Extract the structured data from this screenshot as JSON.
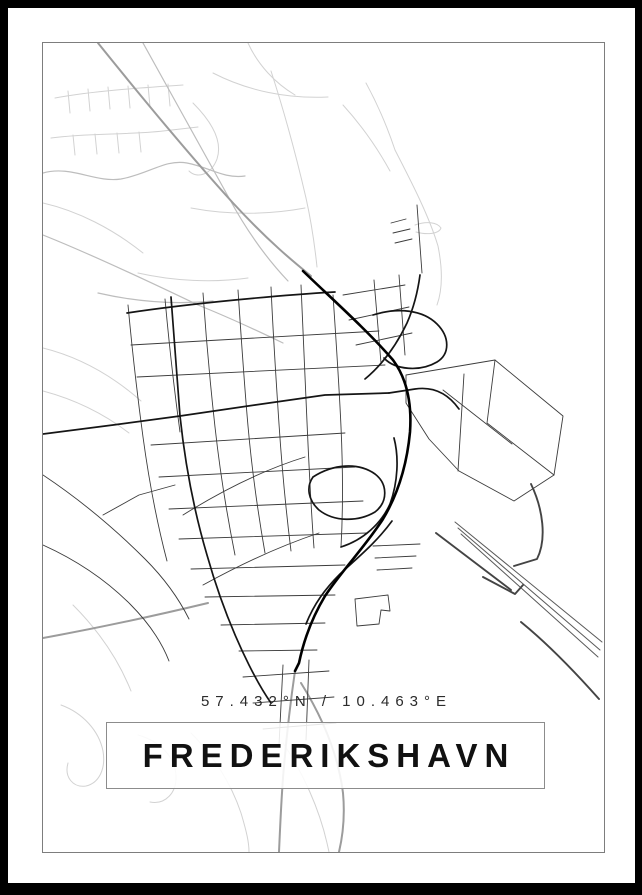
{
  "poster": {
    "title": "FREDERIKSHAVN",
    "coordinates": "57.432°N / 10.463°E",
    "colors": {
      "frame": "#000000",
      "background": "#ffffff",
      "map_border": "#7d7d7d",
      "title_box_border": "#8c8c8c",
      "road_light": "#d2d2d2",
      "road_medium": "#9c9c9c",
      "road_dark": "#151515",
      "road_trunk": "#000000"
    }
  },
  "map": {
    "viewbox": "0 0 561 809",
    "paths": [
      {
        "c": "r1",
        "d": "M12,55 C50,48 95,45 140,42"
      },
      {
        "c": "r1",
        "d": "M25,48 L27,70"
      },
      {
        "c": "r1",
        "d": "M45,46 L47,68"
      },
      {
        "c": "r1",
        "d": "M65,44 L67,66"
      },
      {
        "c": "r1",
        "d": "M85,43 L87,65"
      },
      {
        "c": "r1",
        "d": "M105,42 L107,64"
      },
      {
        "c": "r1",
        "d": "M125,41 L127,63"
      },
      {
        "c": "r1",
        "d": "M8,95 C45,90 85,92 120,88 L155,84"
      },
      {
        "c": "r1",
        "d": "M30,92 L32,112"
      },
      {
        "c": "r1",
        "d": "M52,91 L54,111"
      },
      {
        "c": "r1",
        "d": "M74,90 L76,110"
      },
      {
        "c": "r1",
        "d": "M96,89 L98,109"
      },
      {
        "c": "r1",
        "d": "M150,60 C168,78 180,98 174,116 C168,132 154,136 146,128"
      },
      {
        "c": "r1",
        "d": "M170,30 C205,48 245,56 285,54"
      },
      {
        "c": "r1",
        "d": "M205,0 C215,22 232,40 252,52"
      },
      {
        "c": "r1",
        "d": "M228,28 C241,68 253,112 263,155 C269,182 272,205 274,224"
      },
      {
        "c": "r1",
        "d": "M300,62 C320,84 336,108 347,128"
      },
      {
        "c": "r1",
        "d": "M352,107 C369,140 386,173 395,203 C400,228 399,248 394,262"
      },
      {
        "c": "r1",
        "d": "M352,107 C345,86 335,62 323,40"
      },
      {
        "c": "r1",
        "d": "M372,182 C383,178 394,179 398,185 C396,191 384,192 373,189"
      },
      {
        "c": "r1",
        "d": "M0,160 C35,168 70,186 100,210"
      },
      {
        "c": "r1",
        "d": "M148,165 C185,172 225,172 262,165"
      },
      {
        "c": "r1",
        "d": "M95,230 C130,238 170,240 205,235"
      },
      {
        "c": "r1",
        "d": "M0,305 C40,315 72,335 98,358"
      },
      {
        "c": "r1",
        "d": "M0,348 C30,356 60,370 86,390"
      },
      {
        "c": "r1",
        "d": "M18,662 C40,670 56,688 60,708 C63,726 56,740 43,743 C30,745 21,734 25,720"
      },
      {
        "c": "r1",
        "d": "M95,692 C116,698 131,712 133,732 C134,750 122,762 107,759"
      },
      {
        "c": "r1",
        "d": "M30,562 C56,588 76,618 88,648"
      },
      {
        "c": "r1",
        "d": "M148,690 C170,712 188,740 198,770 C204,790 206,800 206,809"
      },
      {
        "c": "r1",
        "d": "M240,700 C260,730 276,765 284,800 L286,809"
      },
      {
        "c": "r2",
        "d": "M0,130 C28,122 52,140 78,136 C106,131 122,116 144,120 C166,124 180,136 202,133"
      },
      {
        "c": "r2",
        "d": "M100,0 C128,50 158,105 186,155 C206,192 226,218 245,238"
      },
      {
        "c": "r2",
        "d": "M0,192 C50,212 105,238 155,262 C185,274 215,288 240,300"
      },
      {
        "c": "r2",
        "d": "M55,250 C90,258 130,262 170,258"
      },
      {
        "c": "r3",
        "d": "M55,0 C92,46 140,105 190,160 C226,199 252,220 268,233"
      },
      {
        "c": "r3",
        "d": "M252,628 C247,662 243,698 240,735 C238,762 237,787 236,809"
      },
      {
        "c": "r3",
        "d": "M258,640 C278,672 295,710 300,750 C302,772 300,792 296,809"
      },
      {
        "c": "r3",
        "d": "M0,595 C55,585 115,572 165,560"
      },
      {
        "c": "r4",
        "d": "M85,262 C89,305 94,350 100,394 C106,438 114,480 124,518"
      },
      {
        "c": "r4",
        "d": "M122,256 C126,300 131,345 137,389"
      },
      {
        "c": "r4",
        "d": "M160,250 C163,294 167,339 172,384 C177,429 184,472 192,512"
      },
      {
        "c": "r4",
        "d": "M195,247 C198,292 201,338 205,383 C209,428 215,470 222,510"
      },
      {
        "c": "r4",
        "d": "M228,244 C230,290 233,336 236,381 C239,426 243,468 248,508"
      },
      {
        "c": "r4",
        "d": "M258,242 C260,288 262,334 264,379 C266,424 268,466 271,505"
      },
      {
        "c": "r4",
        "d": "M290,252 C293,296 296,340 298,384 C300,428 300,468 298,504"
      },
      {
        "c": "r4",
        "d": "M88,302 L336,288"
      },
      {
        "c": "r4",
        "d": "M94,334 L342,322"
      },
      {
        "c": "r4",
        "d": "M108,402 L302,390"
      },
      {
        "c": "r4",
        "d": "M116,434 L312,424"
      },
      {
        "c": "r4",
        "d": "M126,466 L320,458"
      },
      {
        "c": "r4",
        "d": "M136,496 L324,490"
      },
      {
        "c": "r4",
        "d": "M148,526 L302,522"
      },
      {
        "c": "r4",
        "d": "M162,554 L292,552"
      },
      {
        "c": "r4",
        "d": "M178,582 L282,580"
      },
      {
        "c": "r4",
        "d": "M196,608 L274,607"
      },
      {
        "c": "r4",
        "d": "M300,252 L362,242"
      },
      {
        "c": "r4",
        "d": "M306,277 L366,264"
      },
      {
        "c": "r4",
        "d": "M313,302 L369,290"
      },
      {
        "c": "r4",
        "d": "M331,237 L338,320"
      },
      {
        "c": "r4",
        "d": "M356,232 L362,312"
      },
      {
        "c": "r4",
        "d": "M140,472 C180,447 220,427 262,414"
      },
      {
        "c": "r4",
        "d": "M160,542 C200,520 240,502 276,490"
      },
      {
        "c": "r4",
        "d": "M200,634 L286,628"
      },
      {
        "c": "r4",
        "d": "M210,660 L291,654"
      },
      {
        "c": "r4",
        "d": "M220,686 L293,680"
      },
      {
        "c": "r4",
        "d": "M240,622 L236,702"
      },
      {
        "c": "r4",
        "d": "M266,617 L263,697"
      },
      {
        "c": "r4",
        "d": "M312,556 L345,552 L347,568 L338,567 L336,581 L314,583 Z"
      },
      {
        "c": "r4",
        "d": "M0,432 C36,456 72,486 102,516 C122,536 136,556 146,576"
      },
      {
        "c": "r4",
        "d": "M0,502 C31,516 62,536 87,561 C106,580 119,600 126,618"
      },
      {
        "c": "r4",
        "d": "M60,472 L96,452 L132,442"
      },
      {
        "c": "r4",
        "d": "M348,180 L363,176"
      },
      {
        "c": "r4",
        "d": "M350,190 L367,186"
      },
      {
        "c": "r4",
        "d": "M352,200 L369,196"
      },
      {
        "c": "r4",
        "d": "M374,162 L379,230"
      },
      {
        "c": "r4",
        "d": "M363,332 L452,317 L520,373 L511,432 L471,458 L416,428 L386,396 L363,360 Z"
      },
      {
        "c": "r4",
        "d": "M452,317 L444,380 L511,432"
      },
      {
        "c": "r4",
        "d": "M400,347 L469,401"
      },
      {
        "c": "r4",
        "d": "M421,331 L415,428"
      },
      {
        "c": "r4",
        "d": "M330,503 L377,501"
      },
      {
        "c": "r4",
        "d": "M332,515 L373,513"
      },
      {
        "c": "r4",
        "d": "M334,527 L369,525"
      },
      {
        "c": "r5",
        "d": "M0,391 L70,382 L137,373 L212,362 L282,352 L346,350"
      },
      {
        "c": "r5",
        "d": "M128,254 C131,296 134,336 137,373 C142,420 151,468 164,512 C175,551 190,590 206,622 C214,638 221,650 228,660"
      },
      {
        "c": "r5",
        "d": "M84,270 C150,260 240,252 292,249"
      },
      {
        "c": "r5",
        "d": "M298,504 C320,497 338,481 347,461 C355,439 356,414 351,395"
      },
      {
        "c": "r5",
        "d": "M270,434 C290,421 315,419 332,431 C345,441 345,459 332,469 C315,479 291,479 276,467 C265,457 263,444 270,434"
      },
      {
        "c": "r5",
        "d": "M346,350 L372,346 C392,343 406,352 416,366"
      },
      {
        "c": "r5",
        "d": "M349,478 C333,500 313,516 297,531 C282,546 271,561 263,581"
      },
      {
        "c": "r5",
        "d": "M330,272 C355,264 380,267 394,281 C407,294 407,311 394,319 C377,329 352,327 341,315"
      },
      {
        "c": "r5",
        "d": "M322,336 C340,321 354,301 364,280 C371,264 375,247 377,232"
      },
      {
        "c": "r6",
        "d": "M260,228 C288,255 325,288 350,317 C364,336 369,360 367,389 C364,421 355,451 340,476 C322,504 300,526 282,553 C270,573 261,596 256,620 L252,628"
      },
      {
        "c": "blob",
        "d": "M358,478 L403,473 L406,491 L360,496 Z"
      },
      {
        "c": "r7",
        "d": "M412,479 L559,599"
      },
      {
        "c": "r7",
        "d": "M415,485 L557,607"
      },
      {
        "c": "r7",
        "d": "M418,491 L555,614"
      },
      {
        "c": "r8",
        "d": "M478,579 C505,601 532,629 556,656"
      },
      {
        "c": "r8",
        "d": "M488,441 C500,466 504,496 494,516 L471,523"
      },
      {
        "c": "r8",
        "d": "M393,490 L468,547"
      },
      {
        "c": "r8",
        "d": "M440,534 L472,551 L480,542"
      }
    ]
  }
}
